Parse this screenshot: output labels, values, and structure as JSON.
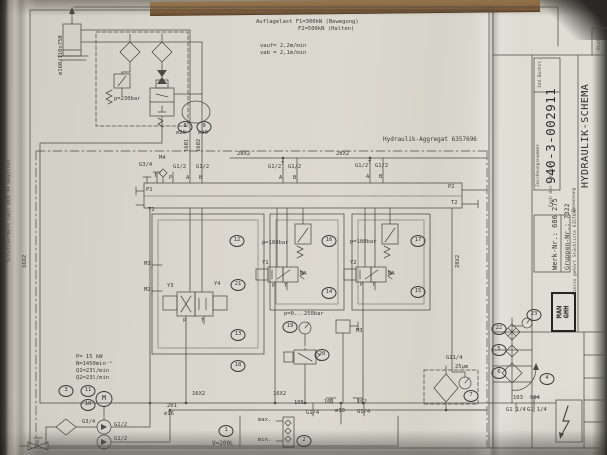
{
  "colors": {
    "paper": "#d9d6cd",
    "ink": "#4c4a42",
    "table": "#8a6844"
  },
  "side_note": "Schutzvermerk nach DIN 34 beachten",
  "title_block": {
    "zeichnungsnummer_label": "Zeichnungsnummer",
    "zeichnungsnummer": "940-3-002911",
    "ind_buchst_label": "Ind.Buchst.",
    "benennung_label": "Benennung",
    "benennung": "HYDRAULIK-SCHEMA",
    "werk_nr": "Werk-Nr.: 686 275",
    "gruppen_nr": "Gruppen-Nr.: 7322",
    "stueckliste_note": "Hierzu gehört Stückliste 6357696",
    "fach_label": "Fach der Kartei:",
    "blatt": "Blatt 1",
    "logo": "MAN\nGHH"
  },
  "annotations": [
    {
      "text": "Auflagelast F1=300kN (Bewegung)",
      "x": 256,
      "y": 19
    },
    {
      "text": "F2=500kN (Halten)",
      "x": 298,
      "y": 26
    },
    {
      "text": "vauf= 2,2m/min",
      "x": 260,
      "y": 43
    },
    {
      "text": "vab = 2,1m/min",
      "x": 260,
      "y": 50
    },
    {
      "text": "⌀160/110x750",
      "x": 58,
      "y": 75,
      "rot": -90
    },
    {
      "text": "p=230bar",
      "x": 114,
      "y": 96
    },
    {
      "text": "Hydraulik-Aggregat 6357696",
      "x": 383,
      "y": 137,
      "cls": "t6"
    },
    {
      "text": "28X2",
      "x": 237,
      "y": 151
    },
    {
      "text": "28X2",
      "x": 336,
      "y": 151
    },
    {
      "text": "⌀20",
      "x": 176,
      "y": 130
    },
    {
      "text": "⌀20",
      "x": 198,
      "y": 130
    },
    {
      "text": "1601",
      "x": 184,
      "y": 152,
      "rot": -90
    },
    {
      "text": "1602",
      "x": 196,
      "y": 152,
      "rot": -90
    },
    {
      "text": "G3/4",
      "x": 139,
      "y": 162
    },
    {
      "text": "M4",
      "x": 159,
      "y": 155
    },
    {
      "text": "T",
      "x": 154,
      "y": 173
    },
    {
      "text": "P",
      "x": 169,
      "y": 175
    },
    {
      "text": "A",
      "x": 186,
      "y": 175
    },
    {
      "text": "B",
      "x": 199,
      "y": 175
    },
    {
      "text": "G1/2",
      "x": 173,
      "y": 164
    },
    {
      "text": "G1/2",
      "x": 196,
      "y": 164
    },
    {
      "text": "G1/2",
      "x": 268,
      "y": 164
    },
    {
      "text": "T",
      "x": 281,
      "y": 161
    },
    {
      "text": "G1/2",
      "x": 288,
      "y": 164
    },
    {
      "text": "A",
      "x": 279,
      "y": 175
    },
    {
      "text": "B",
      "x": 293,
      "y": 175
    },
    {
      "text": "G1/2",
      "x": 355,
      "y": 163
    },
    {
      "text": "T",
      "x": 368,
      "y": 160
    },
    {
      "text": "G1/2",
      "x": 375,
      "y": 163
    },
    {
      "text": "A",
      "x": 366,
      "y": 174
    },
    {
      "text": "B",
      "x": 379,
      "y": 174
    },
    {
      "text": "P1",
      "x": 146,
      "y": 187
    },
    {
      "text": "T1",
      "x": 148,
      "y": 207
    },
    {
      "text": "P2",
      "x": 448,
      "y": 184
    },
    {
      "text": "T2",
      "x": 451,
      "y": 200
    },
    {
      "text": "p=180bar",
      "x": 262,
      "y": 240
    },
    {
      "text": "p=180bar",
      "x": 350,
      "y": 239
    },
    {
      "text": "M1",
      "x": 144,
      "y": 261
    },
    {
      "text": "M2",
      "x": 144,
      "y": 287
    },
    {
      "text": "Y3",
      "x": 167,
      "y": 283
    },
    {
      "text": "Y4",
      "x": 214,
      "y": 281
    },
    {
      "text": "P",
      "x": 183,
      "y": 318
    },
    {
      "text": "T",
      "x": 201,
      "y": 318
    },
    {
      "text": "Y1",
      "x": 262,
      "y": 260
    },
    {
      "text": "MA",
      "x": 300,
      "y": 271
    },
    {
      "text": "P",
      "x": 272,
      "y": 283
    },
    {
      "text": "T",
      "x": 284,
      "y": 283
    },
    {
      "text": "Y2",
      "x": 350,
      "y": 260
    },
    {
      "text": "MA",
      "x": 388,
      "y": 271
    },
    {
      "text": "P",
      "x": 360,
      "y": 282
    },
    {
      "text": "T",
      "x": 372,
      "y": 282
    },
    {
      "text": "p=0...250bar",
      "x": 284,
      "y": 311
    },
    {
      "text": "M3",
      "x": 356,
      "y": 328
    },
    {
      "text": "P= 15 kW",
      "x": 76,
      "y": 354
    },
    {
      "text": "N=1450min⁻¹",
      "x": 76,
      "y": 361
    },
    {
      "text": "Q1=23l/min",
      "x": 76,
      "y": 368
    },
    {
      "text": "Q2=23l/min",
      "x": 76,
      "y": 375
    },
    {
      "text": "16X2",
      "x": 192,
      "y": 391
    },
    {
      "text": "16X2",
      "x": 273,
      "y": 391
    },
    {
      "text": "16X2",
      "x": 22,
      "y": 268,
      "rot": -90
    },
    {
      "text": "28X2",
      "x": 455,
      "y": 268,
      "rot": -90
    },
    {
      "text": "201",
      "x": 167,
      "y": 403
    },
    {
      "text": "⌀16",
      "x": 164,
      "y": 411
    },
    {
      "text": "105",
      "x": 294,
      "y": 400
    },
    {
      "text": "101",
      "x": 324,
      "y": 399
    },
    {
      "text": "102",
      "x": 357,
      "y": 399
    },
    {
      "text": "G1/4",
      "x": 306,
      "y": 410
    },
    {
      "text": "⌀10",
      "x": 335,
      "y": 408
    },
    {
      "text": "G1/4",
      "x": 357,
      "y": 409
    },
    {
      "text": "max.",
      "x": 258,
      "y": 417
    },
    {
      "text": "min.",
      "x": 258,
      "y": 437
    },
    {
      "text": "V=200L",
      "x": 212,
      "y": 441,
      "cls": "t6"
    },
    {
      "text": "G3/4",
      "x": 82,
      "y": 419
    },
    {
      "text": "G1/2",
      "x": 114,
      "y": 422
    },
    {
      "text": "G1/2",
      "x": 114,
      "y": 436
    },
    {
      "text": "G11/4",
      "x": 446,
      "y": 355
    },
    {
      "text": "25μm",
      "x": 455,
      "y": 364
    },
    {
      "text": "103",
      "x": 513,
      "y": 395
    },
    {
      "text": "104",
      "x": 530,
      "y": 395
    },
    {
      "text": "G1 1/4",
      "x": 506,
      "y": 407
    },
    {
      "text": "G1 1/4",
      "x": 527,
      "y": 407
    }
  ],
  "components": [
    {
      "n": "1",
      "x": 226,
      "y": 431
    },
    {
      "n": "2",
      "x": 304,
      "y": 441
    },
    {
      "n": "3",
      "x": 66,
      "y": 391
    },
    {
      "n": "4",
      "x": 547,
      "y": 379
    },
    {
      "n": "5",
      "x": 499,
      "y": 350
    },
    {
      "n": "6",
      "x": 499,
      "y": 373
    },
    {
      "n": "7",
      "x": 471,
      "y": 396
    },
    {
      "n": "8",
      "x": 185,
      "y": 127
    },
    {
      "n": "9",
      "x": 204,
      "y": 127
    },
    {
      "n": "10",
      "x": 88,
      "y": 405
    },
    {
      "n": "11",
      "x": 88,
      "y": 391
    },
    {
      "n": "M",
      "x": 104,
      "y": 399,
      "cls": "big"
    },
    {
      "n": "12",
      "x": 237,
      "y": 241
    },
    {
      "n": "13",
      "x": 238,
      "y": 335
    },
    {
      "n": "14",
      "x": 329,
      "y": 293
    },
    {
      "n": "15",
      "x": 418,
      "y": 292
    },
    {
      "n": "16",
      "x": 329,
      "y": 241
    },
    {
      "n": "17",
      "x": 418,
      "y": 241
    },
    {
      "n": "18",
      "x": 238,
      "y": 366
    },
    {
      "n": "19",
      "x": 290,
      "y": 327
    },
    {
      "n": "20",
      "x": 322,
      "y": 355
    },
    {
      "n": "21",
      "x": 238,
      "y": 285
    },
    {
      "n": "22",
      "x": 499,
      "y": 329
    },
    {
      "n": "23",
      "x": 534,
      "y": 315
    }
  ]
}
